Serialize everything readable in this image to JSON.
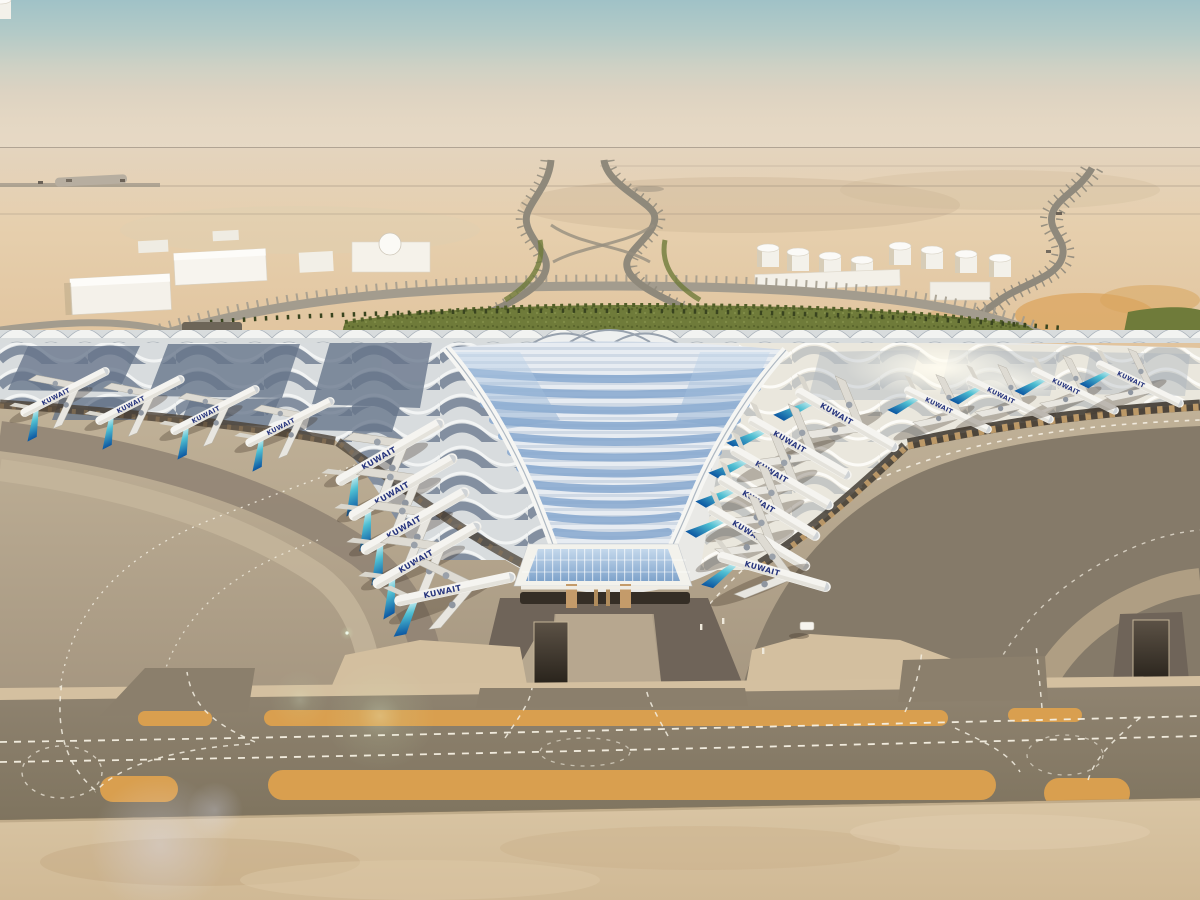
{
  "meta": {
    "description": "Aerial architectural rendering of a trefoil airport terminal in the desert with a ribbed canopy roof, aircraft parked at gates, palm-lined approach roads and taxiways",
    "scene_type": "architectural-rendering",
    "time_of_day": "hazy daylight"
  },
  "airline": {
    "title": "KUWAIT",
    "arabic_title": "الكويتية",
    "tail_colors": [
      "#6fd0da",
      "#0e59a4"
    ]
  },
  "palette": {
    "sky_top": "#a0c2c7",
    "sky_horizon": "#e7d9c5",
    "desert": "#e3cda9",
    "greenery": "#6f7b3a",
    "roof_white": "#f2f2ef",
    "roof_glass": "#8fb0d4",
    "roof_panel_dark": "#66758a",
    "apron_light": "#bdae96",
    "apron_dark": "#7e7364",
    "taxiway_grey": "#8b7f6c",
    "shoulder_orange": "#d99f4f",
    "marking_white": "#f5f0e3",
    "facade_tan": "#c9a26d"
  },
  "scene": {
    "background": {
      "left_buildings": "white warehouses with dome",
      "right_buildings": "white storage tank farm",
      "landscape": "palm-lined approach roads with green median and landscaped band"
    },
    "terminal": {
      "name": "trefoil terminal",
      "roof": "ribbed canopy with chevron skylights",
      "gates_left_row": 5,
      "gates_right_row": 6,
      "gates_left_wing": 4,
      "gates_right_wing": 4
    },
    "aircraft": {
      "groups": [
        {
          "name": "left-inner-row",
          "planes": [
            [
              390,
              452,
              -30,
              1
            ],
            [
              403,
              487,
              -30,
              1
            ],
            [
              415,
              521,
              -30,
              1
            ],
            [
              427,
              555,
              -30,
              1
            ],
            [
              455,
              589,
              -12,
              1
            ]
          ]
        },
        {
          "name": "right-inner-row",
          "planes": [
            [
              847,
              420,
              30,
              0.95
            ],
            [
              800,
              448,
              30,
              0.95
            ],
            [
              782,
              478,
              30,
              0.95
            ],
            [
              769,
              508,
              31,
              0.95
            ],
            [
              759,
              538,
              31,
              0.95
            ],
            [
              774,
              572,
              16,
              0.95
            ]
          ]
        },
        {
          "name": "left-wing-row",
          "planes": [
            [
              65,
              392,
              -27,
              0.8
            ],
            [
              140,
              400,
              -27,
              0.8
            ],
            [
              215,
              410,
              -27,
              0.8
            ],
            [
              290,
              422,
              -27,
              0.8
            ]
          ]
        },
        {
          "name": "right-wing-row",
          "planes": [
            [
              948,
              410,
              26,
              0.78
            ],
            [
              1010,
              400,
              26,
              0.78
            ],
            [
              1075,
              391,
              26,
              0.78
            ],
            [
              1140,
              384,
              26,
              0.78
            ]
          ]
        }
      ]
    },
    "ground_vehicles": [
      {
        "name": "service-van",
        "x": 806,
        "y": 628
      }
    ],
    "markings": {
      "taxiway_lines": "white dashed",
      "shoulders": "orange strips"
    }
  }
}
